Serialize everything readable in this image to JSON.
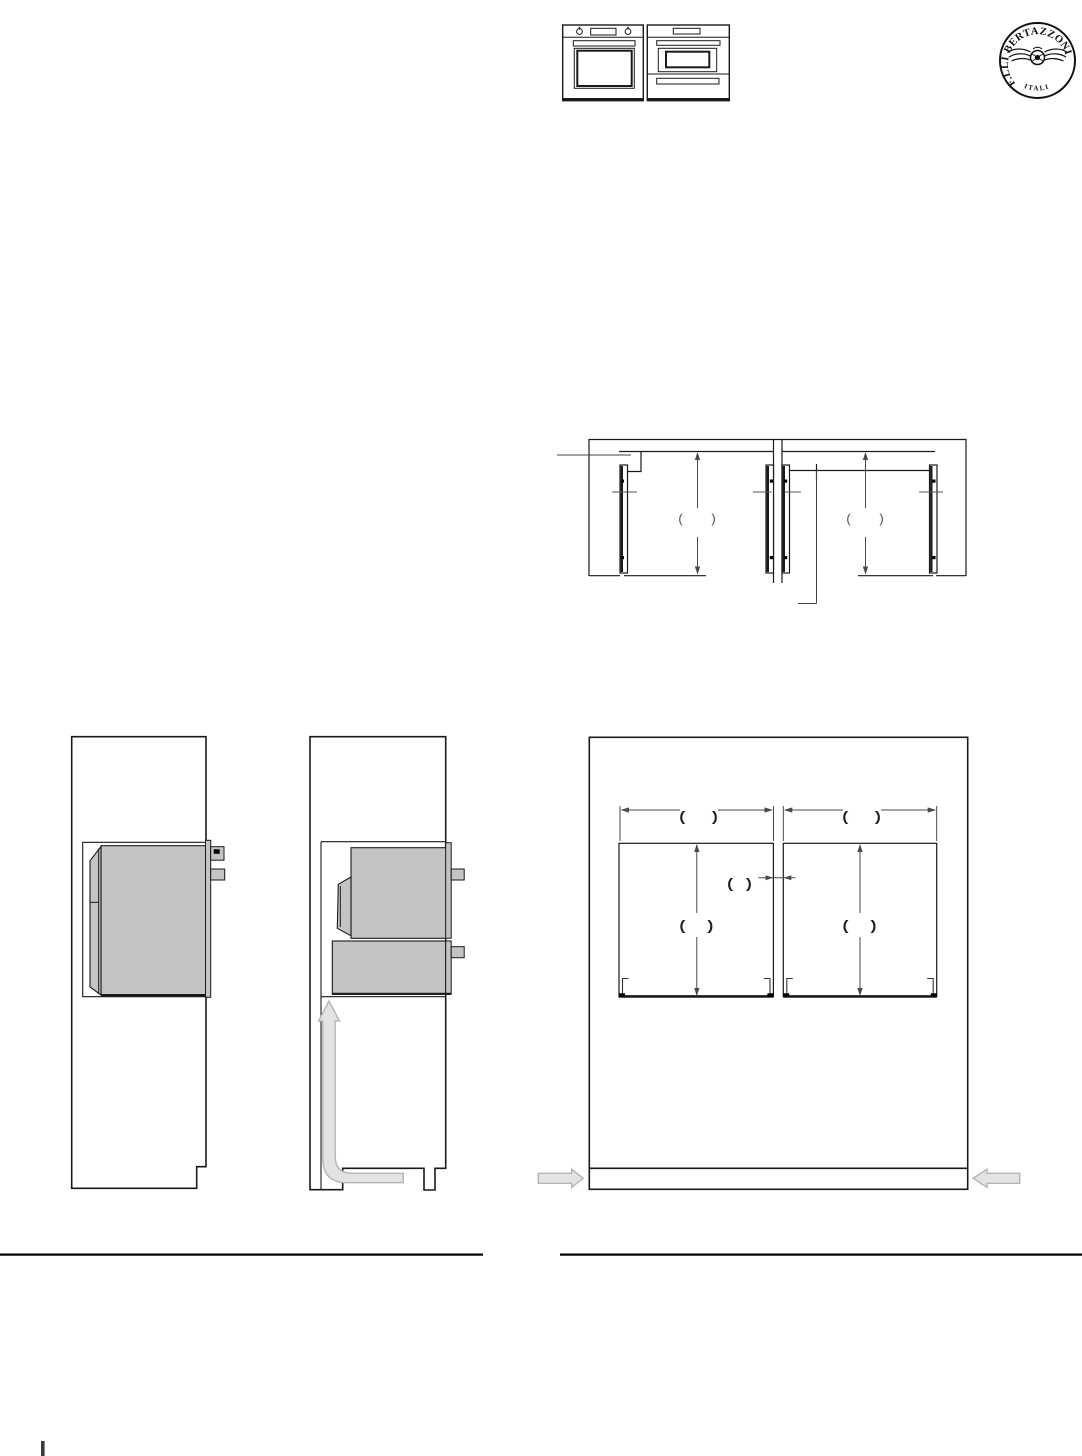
{
  "logo": {
    "brand_arc": "F.LLI BERTAZZONI",
    "country": "ITALIA"
  },
  "header_icons": {
    "left_unit": "single-wall-oven",
    "right_unit": "speed-oven-with-warming-drawer"
  },
  "plan_view": {
    "width_label_left": "(      )",
    "width_label_right": "(      )"
  },
  "front_view": {
    "width_label_left": "(      )",
    "width_label_right": "(      )",
    "gap_label": "(   )",
    "height_label_left": "(     )",
    "height_label_right": "(     )"
  },
  "colors": {
    "line": "#1a1a1a",
    "dim_line": "#4a4a4a",
    "oven_fill": "#c4c4c4",
    "airflow_fill": "#e3e3e3",
    "airflow_stroke": "#b5b5b5"
  }
}
